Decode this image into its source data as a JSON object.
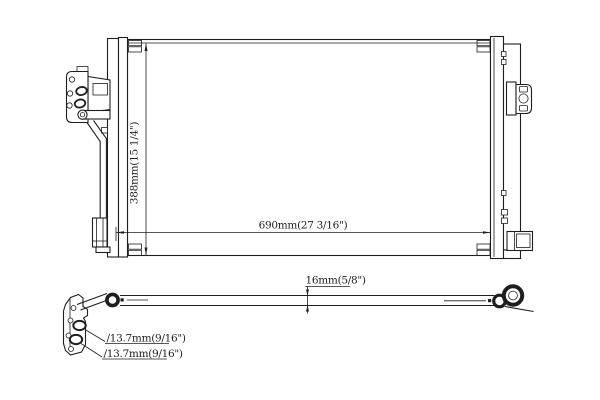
{
  "page": {
    "background": "#ffffff",
    "line_color": "#1e1e1e"
  },
  "drawing": {
    "dimensions": {
      "height": "388mm(15 1/4\")",
      "width": "690mm(27 3/16\")",
      "depth": "16mm(5/8\")",
      "port1": "∕13.7mm(9/16\")",
      "port2": "∕13.7mm(9/16\")"
    }
  }
}
